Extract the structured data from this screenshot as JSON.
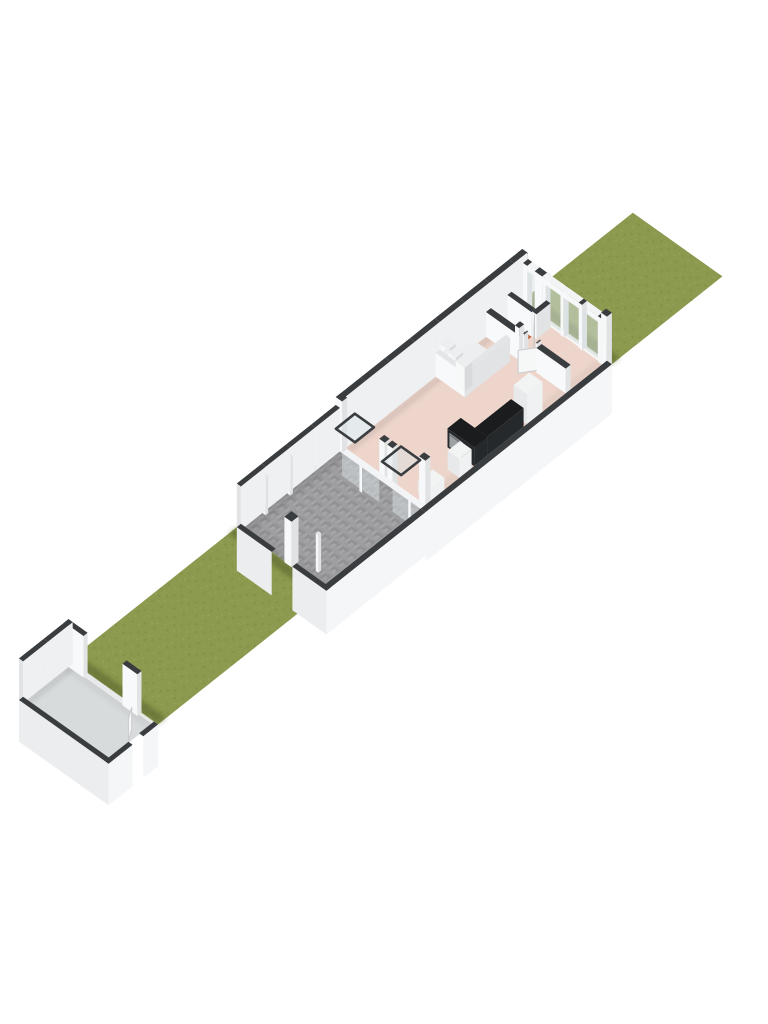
{
  "scene": {
    "label": "3D floorplan render of ground floor with gardens",
    "projection": {
      "ox": 19,
      "oy": 700,
      "ux": 16.5,
      "uy": -13.1,
      "vx": 16.6,
      "vy": 11.8,
      "hz": 19.8
    },
    "colors": {
      "bg": "#ffffff",
      "grass": "#8B9A4F",
      "grassDot1": "#7F8F45",
      "grassDot2": "#95A45A",
      "grassShadow": "rgba(62,72,30,0.40)",
      "paving": "#9B9B9E",
      "pavingA": "#A6A6A8",
      "pavingB": "#929295",
      "pavingC": "#9F9FA2",
      "garageFloor": "#D8DBDC",
      "floorPink": "#EDD5CB",
      "floorTerracotta": "#BF5B3A",
      "floorCloset": "#E9EAEC",
      "capDark": "#3A3D3F",
      "capLight": "#E4E5E7",
      "wallLight": "#EFF0F2",
      "wallBright": "#F8F9FA",
      "wallShade": "#DMISSING",
      "wallSW": "#EBEDEE",
      "wallSE": "#F5F6F7",
      "wallEnd": "#E2E3E5",
      "glass": "#D9E2E4",
      "glassStroke": "#3A3D40",
      "rail": "#F3F4F5",
      "post": "#F7F8F9",
      "postSide": "#E0E2E4",
      "threshold": "#E8E9EA",
      "counterTop": "#1A1C1D",
      "counterFace": "#26292B",
      "ovenGray": "#9EA2A4",
      "ovenHandle": "#6E7173",
      "sinkDark": "#0D0E0F",
      "sinkRim": "#AEB2B4",
      "fridgeTop": "#F2F3F3",
      "fridgeSW": "#E7E9EA",
      "fridgeSE": "#F0F1F2",
      "treadTop": "#EDEEEF",
      "treadRiser": "#F7F8F8",
      "treadSide": "#D9DADC",
      "doorLeaf": "#F6F7F7",
      "doorEdge": "#C8CACC",
      "jambDark": "#55585A",
      "floorShadow": "rgba(0,0,0,0.09)",
      "floorShadowSoft": "rgba(0,0,0,0.05)"
    },
    "plot": {
      "width_m": 5.4,
      "segments": [
        {
          "name": "garage",
          "u0": 0.0,
          "u1": 3.0
        },
        {
          "name": "front-garden",
          "u0": 3.0,
          "u1": 13.2
        },
        {
          "name": "patio",
          "u0": 13.2,
          "u1": 19.2
        },
        {
          "name": "house",
          "u0": 19.2,
          "u1": 30.5
        },
        {
          "name": "back-garden",
          "u0": 30.5,
          "u1": 37.2
        }
      ]
    },
    "floors": [
      {
        "name": "front-garden-grass",
        "u0": 3.0,
        "v0": 0,
        "u1": 13.2,
        "v1": 5.4,
        "fill": "pat:grass"
      },
      {
        "name": "back-garden-grass",
        "u0": 30.5,
        "v0": 0,
        "u1": 37.2,
        "v1": 5.4,
        "fill": "pat:grass"
      },
      {
        "name": "garage-floor",
        "u0": 0.2,
        "v0": 0.2,
        "u1": 2.85,
        "v1": 5.2,
        "fill": "garageFloor"
      },
      {
        "name": "patio-paving",
        "u0": 13.2,
        "v0": 0,
        "u1": 19.2,
        "v1": 5.4,
        "fill": "pat:paving"
      },
      {
        "name": "house-floor",
        "u0": 19.4,
        "v0": 0.28,
        "u1": 30.25,
        "v1": 5.12,
        "fill": "floorPink"
      },
      {
        "name": "wc-floor",
        "u0": 28.3,
        "v0": 0.3,
        "u1": 29.3,
        "v1": 1.75,
        "fill": "floorTerracotta"
      },
      {
        "name": "closet-floor",
        "u0": 29.55,
        "v0": 0.3,
        "u1": 30.2,
        "v1": 1.75,
        "fill": "floorCloset"
      }
    ],
    "shadows": [
      {
        "name": "garage-shadow-on-grass",
        "u0": 3.0,
        "v0": 0,
        "u1": 3.5,
        "v1": 5.4,
        "fill": "grassShadow"
      },
      {
        "name": "patio-wall-shadow-on-grass",
        "u0": 12.7,
        "v0": 0,
        "u1": 13.2,
        "v1": 5.4,
        "fill": "grassShadow"
      },
      {
        "name": "house-shadow-on-back-grass",
        "u0": 30.5,
        "v0": 0,
        "u1": 31.0,
        "v1": 5.4,
        "fill": "grassShadow"
      },
      {
        "name": "patio-nw-wall-shadow",
        "u0": 13.45,
        "v0": 0.25,
        "u1": 19.2,
        "v1": 0.62,
        "fill": "floorShadow"
      },
      {
        "name": "patio-sw-wall-shadow",
        "u0": 13.45,
        "v0": 0.25,
        "u1": 13.75,
        "v1": 5.1,
        "fill": "floorShadowSoft"
      },
      {
        "name": "house-nw-wall-shadow",
        "u0": 19.5,
        "v0": 0.3,
        "u1": 30.2,
        "v1": 0.64,
        "fill": "floorShadow"
      },
      {
        "name": "house-se-wall-shadow",
        "u0": 19.5,
        "v0": 4.78,
        "u1": 30.2,
        "v1": 5.1,
        "fill": "floorShadowSoft"
      },
      {
        "name": "garage-nw-wall-shadow",
        "u0": 0.25,
        "v0": 0.2,
        "u1": 2.85,
        "v1": 0.55,
        "fill": "floorShadow"
      },
      {
        "name": "garage-ne-wall-shadow",
        "u0": 2.5,
        "v0": 0.2,
        "u1": 2.85,
        "v1": 5.2,
        "fill": "floorShadowSoft"
      }
    ],
    "walls": [
      {
        "name": "garage-nw-wall",
        "t": "farU",
        "u0": 0,
        "v0": 0,
        "u1": 3.0,
        "v1": 0.25,
        "h": 2.1,
        "cap": "capDark",
        "in": "wallLight"
      },
      {
        "name": "garage-ne-wall-a",
        "t": "farV",
        "u0": 2.75,
        "v0": 0,
        "u1": 3.0,
        "v1": 1.15,
        "h": 2.1,
        "cap": "capDark",
        "in": "wallBright"
      },
      {
        "name": "garage-ne-wall-b",
        "t": "farV",
        "u0": 2.75,
        "v0": 3.5,
        "u1": 3.0,
        "v1": 4.4,
        "h": 2.1,
        "cap": "capDark",
        "in": "wallBright"
      },
      {
        "name": "garage-sw-wall",
        "t": "nearV",
        "uIn": 0.25,
        "v0": 0,
        "v1": 5.4,
        "h": 2.1,
        "th": 0.25,
        "cap": "capDark",
        "out": "wallSW"
      },
      {
        "name": "garage-se-wall-a",
        "t": "nearU",
        "vIn": 5.15,
        "u0": 0,
        "u1": 1.45,
        "h": 2.1,
        "th": 0.25,
        "cap": "capDark",
        "out": "wallSE"
      },
      {
        "name": "garage-se-wall-b",
        "t": "nearU",
        "vIn": 5.15,
        "u0": 2.1,
        "u1": 3.0,
        "h": 2.1,
        "th": 0.25,
        "cap": "capDark",
        "out": "wallSE"
      },
      {
        "name": "patio-nw-wall",
        "t": "farU",
        "u0": 13.2,
        "v0": 0,
        "u1": 19.2,
        "v1": 0.25,
        "h": 2.2,
        "cap": "capDark",
        "in": "wallLight"
      },
      {
        "name": "patio-sw-wall-a",
        "t": "nearV",
        "uIn": 13.45,
        "v0": 0,
        "v1": 2.1,
        "h": 2.2,
        "th": 0.25,
        "cap": "capDark",
        "out": "wallSW"
      },
      {
        "name": "patio-sw-wall-b",
        "t": "nearV",
        "uIn": 13.45,
        "v0": 3.35,
        "v1": 5.4,
        "h": 2.2,
        "th": 0.25,
        "cap": "capDark",
        "out": "wallSW"
      },
      {
        "name": "patio-se-wall",
        "t": "nearU",
        "vIn": 5.1,
        "u0": 13.2,
        "u1": 19.2,
        "h": 2.2,
        "th": 0.3,
        "cap": "capDark",
        "out": "wallSE"
      },
      {
        "name": "house-nw-wall",
        "t": "farU",
        "u0": 19.2,
        "v0": 0,
        "u1": 30.5,
        "v1": 0.3,
        "h": 2.6,
        "cap": "capDark",
        "in": "wallLight"
      },
      {
        "name": "house-se-wall",
        "t": "nearU",
        "vIn": 5.1,
        "u0": 19.2,
        "u1": 30.5,
        "h": 2.5,
        "th": 0.3,
        "cap": "capDark",
        "out": "wallSE"
      },
      {
        "name": "ne-facade-solid-a",
        "t": "farV",
        "u0": 30.2,
        "v0": 0.35,
        "u1": 30.5,
        "v1": 0.6,
        "h": 2.3,
        "cap": "capDark",
        "in": "wallBright"
      },
      {
        "name": "ne-facade-solid-b",
        "t": "farV",
        "u0": 30.2,
        "v0": 1.05,
        "u1": 30.5,
        "v1": 1.5,
        "h": 2.3,
        "cap": "capDark",
        "in": "wallBright"
      },
      {
        "name": "stairs-wall-sw",
        "t": "box",
        "u0": 24.95,
        "v0": 0.3,
        "u1": 25.2,
        "v1": 2.05,
        "h": 1.2,
        "cap": "capLight",
        "sw": "wallBright",
        "se": "wallEnd"
      },
      {
        "name": "stairs-wall-se",
        "t": "box",
        "u0": 24.95,
        "v0": 1.8,
        "u1": 27.7,
        "v1": 2.05,
        "h": 1.2,
        "cap": "capLight",
        "sw": "wallBright",
        "se": "wallEnd"
      },
      {
        "name": "hall-wall-a",
        "t": "box",
        "u0": 28.0,
        "v0": 0.3,
        "u1": 28.3,
        "v1": 2.5,
        "h": 1.25,
        "cap": "capDark",
        "sw": "wallBright",
        "se": "wallEnd"
      },
      {
        "name": "hall-wall-b",
        "t": "box",
        "u0": 28.0,
        "v0": 3.35,
        "u1": 28.3,
        "v1": 5.1,
        "h": 1.25,
        "cap": "capDark",
        "sw": "wallBright",
        "se": "wallEnd"
      },
      {
        "name": "wc-wall-a",
        "t": "box",
        "u0": 28.3,
        "v0": 1.75,
        "u1": 28.6,
        "v1": 2.0,
        "h": 1.25,
        "cap": "capDark",
        "sw": "wallBright",
        "se": "wallEnd"
      },
      {
        "name": "wc-wall-b",
        "t": "box",
        "u0": 29.35,
        "v0": 1.75,
        "u1": 30.2,
        "v1": 2.0,
        "h": 1.25,
        "cap": "capDark",
        "sw": "wallBright",
        "se": "wallEnd"
      },
      {
        "name": "wc-closet-wall",
        "t": "box",
        "u0": 29.3,
        "v0": 0.3,
        "u1": 29.55,
        "v1": 1.75,
        "h": 1.25,
        "cap": "capDark",
        "sw": "wallBright",
        "se": "wallEnd"
      }
    ],
    "piers": [
      {
        "name": "sw-facade-corner-pier-nw",
        "u0": 19.2,
        "v0": 0,
        "u1": 19.5,
        "v1": 0.38,
        "h": 2.6,
        "cap": "capDark"
      },
      {
        "name": "sw-facade-corner-pier-se",
        "u0": 19.2,
        "v0": 5.02,
        "u1": 19.5,
        "v1": 5.4,
        "h": 2.6,
        "cap": "capDark"
      },
      {
        "name": "sw-facade-mid-pier-a",
        "u0": 19.2,
        "v0": 2.62,
        "u1": 19.5,
        "v1": 2.95,
        "h": 2.05,
        "cap": "capDark"
      },
      {
        "name": "sw-facade-mid-pier-b",
        "u0": 19.2,
        "v0": 3.1,
        "u1": 19.5,
        "v1": 3.42,
        "h": 2.05,
        "cap": "capDark"
      },
      {
        "name": "ne-facade-corner-pier-nw",
        "u0": 30.2,
        "v0": 0,
        "u1": 30.5,
        "v1": 0.35,
        "h": 2.6,
        "cap": "capDark"
      },
      {
        "name": "ne-facade-corner-pier-se",
        "u0": 30.2,
        "v0": 5.05,
        "u1": 30.5,
        "v1": 5.4,
        "h": 2.6,
        "cap": "capDark"
      },
      {
        "name": "patio-gate-post",
        "u0": 13.15,
        "v0": 2.92,
        "u1": 13.57,
        "v1": 3.35,
        "h": 2.3,
        "cap": "capDark"
      },
      {
        "name": "patio-fence-post-1",
        "u0": 14.5,
        "v0": 0.28,
        "u1": 14.66,
        "v1": 0.44,
        "h": 1.9,
        "cap": "capLight"
      },
      {
        "name": "patio-fence-post-2",
        "u0": 16.0,
        "v0": 0.28,
        "u1": 16.16,
        "v1": 0.44,
        "h": 1.9,
        "cap": "capLight"
      },
      {
        "name": "patio-fence-post-3",
        "u0": 13.7,
        "v0": 4.26,
        "u1": 13.86,
        "v1": 4.42,
        "h": 1.9,
        "cap": "capLight"
      },
      {
        "name": "ne-facade-post-1",
        "u0": 30.2,
        "v0": 1.5,
        "u1": 30.5,
        "v1": 1.7,
        "h": 2.3,
        "cap": "capDark"
      },
      {
        "name": "ne-facade-post-2",
        "u0": 30.2,
        "v0": 2.6,
        "u1": 30.5,
        "v1": 2.8,
        "h": 2.3,
        "cap": "capDark"
      },
      {
        "name": "ne-facade-post-3",
        "u0": 30.2,
        "v0": 3.7,
        "u1": 30.5,
        "v1": 3.9,
        "h": 2.3,
        "cap": "capDark"
      },
      {
        "name": "ne-facade-post-4",
        "u0": 30.2,
        "v0": 4.85,
        "u1": 30.5,
        "v1": 5.05,
        "h": 2.3,
        "cap": "capDark"
      },
      {
        "name": "door-jamb-a",
        "u0": 28.03,
        "v0": 2.5,
        "u1": 28.27,
        "v1": 2.58,
        "h": 1.45,
        "cap": "jambDark"
      },
      {
        "name": "door-jamb-b",
        "u0": 28.03,
        "v0": 3.27,
        "u1": 28.27,
        "v1": 3.35,
        "h": 1.45,
        "cap": "jambDark"
      }
    ],
    "glazing": [
      {
        "name": "rear-window-slit",
        "t": "vglass",
        "u": 30.25,
        "v0": 0.6,
        "v1": 1.05,
        "h0": 0.08,
        "h1": 2.0
      },
      {
        "name": "rear-window-1",
        "t": "vglass",
        "u": 30.25,
        "v0": 1.7,
        "v1": 2.6,
        "h0": 0.08,
        "h1": 2.0
      },
      {
        "name": "rear-window-2",
        "t": "vglass",
        "u": 30.25,
        "v0": 2.8,
        "v1": 3.7,
        "h0": 0.08,
        "h1": 2.0
      },
      {
        "name": "rear-window-3",
        "t": "vglass",
        "u": 30.25,
        "v0": 3.9,
        "v1": 4.85,
        "h0": 0.08,
        "h1": 2.0
      },
      {
        "name": "rear-window-rail",
        "t": "railbox",
        "u0": 30.2,
        "v0": 1.5,
        "u1": 30.5,
        "v1": 5.05,
        "h0": 2.0,
        "h1": 2.3
      },
      {
        "name": "rear-slit-rail",
        "t": "railbox",
        "u0": 30.2,
        "v0": 0.6,
        "u1": 30.5,
        "v1": 1.05,
        "h0": 2.0,
        "h1": 2.3
      },
      {
        "name": "front-facade-rail",
        "t": "hangcap",
        "uIn": 19.5,
        "v0": 0.38,
        "v1": 5.02,
        "th": 0.3,
        "fill": "rail"
      },
      {
        "name": "front-glass-1",
        "t": "hangglass",
        "uIn": 19.5,
        "v0": 0.38,
        "v1": 1.42,
        "th": 0.3,
        "dh": 1.15
      },
      {
        "name": "front-glass-2",
        "t": "hangglass",
        "uIn": 19.5,
        "v0": 1.58,
        "v1": 2.62,
        "th": 0.3,
        "dh": 1.15
      },
      {
        "name": "front-glass-3",
        "t": "hangglass",
        "uIn": 19.5,
        "v0": 3.42,
        "v1": 4.36,
        "th": 0.3,
        "dh": 1.15
      },
      {
        "name": "front-glass-4",
        "t": "hangglass",
        "uIn": 19.5,
        "v0": 4.52,
        "v1": 5.02,
        "th": 0.3,
        "dh": 1.15
      },
      {
        "name": "front-post-1",
        "t": "hangpost",
        "uIn": 19.5,
        "v0": 1.42,
        "v1": 1.58,
        "th": 0.3,
        "dh": 1.3
      },
      {
        "name": "front-post-2",
        "t": "hangpost",
        "uIn": 19.5,
        "v0": 4.36,
        "v1": 4.52,
        "th": 0.3,
        "dh": 1.3
      }
    ],
    "open_panels": [
      {
        "name": "open-window-panel-1",
        "u0": 18.6,
        "v0": 0.6,
        "u1": 19.75,
        "v1": 1.75,
        "h": 1.75
      },
      {
        "name": "open-window-panel-2",
        "u0": 18.6,
        "v0": 3.38,
        "u1": 19.75,
        "v1": 4.53,
        "h": 1.75
      }
    ],
    "stairs": {
      "straight": {
        "count": 7,
        "uStart": 27.4,
        "step": 0.3,
        "v0": 0.35,
        "v1": 1.78,
        "h0": 0.14,
        "rise": 0.15
      },
      "winders": [
        {
          "u0": 25.2,
          "v0": 1.25,
          "u1": 25.66,
          "v1": 1.8,
          "h": 1.19
        },
        {
          "u0": 25.2,
          "v0": 0.8,
          "u1": 25.66,
          "v1": 1.25,
          "h": 1.34
        },
        {
          "u0": 25.2,
          "v0": 0.35,
          "u1": 25.66,
          "v1": 0.8,
          "h": 1.49
        }
      ]
    },
    "furniture": [
      {
        "name": "kitchen-counter-leg",
        "t": "box3",
        "u0": 22.45,
        "v0": 3.5,
        "u1": 23.25,
        "v1": 5.1,
        "h": 0.95,
        "top": "counterTop",
        "sw": "counterFace",
        "se": "counterFace"
      },
      {
        "name": "kitchen-counter-run",
        "t": "box3",
        "u0": 23.25,
        "v0": 4.35,
        "u1": 25.45,
        "v1": 5.1,
        "h": 0.95,
        "top": "counterTop",
        "sw": "counterFace",
        "se": "counterFace"
      },
      {
        "name": "oven-front",
        "t": "vpanel",
        "u": 22.44,
        "v0": 3.62,
        "v1": 4.42,
        "h0": 0.1,
        "h1": 0.8,
        "fill": "ovenGray"
      },
      {
        "name": "oven-handle",
        "t": "vpanel",
        "u": 22.43,
        "v0": 3.66,
        "v1": 4.38,
        "h0": 0.68,
        "h1": 0.76,
        "fill": "ovenHandle"
      },
      {
        "name": "kitchen-sink",
        "t": "hpanel",
        "u0": 22.58,
        "v0": 3.64,
        "u1": 23.12,
        "v1": 4.3,
        "h": 0.96,
        "fill": "sinkDark",
        "stroke": "sinkRim"
      },
      {
        "name": "fridge",
        "t": "box3",
        "u0": 25.65,
        "v0": 4.3,
        "u1": 26.6,
        "v1": 5.1,
        "h": 1.5,
        "top": "fridgeTop",
        "sw": "fridgeSW",
        "se": "fridgeSE"
      },
      {
        "name": "low-cabinet",
        "t": "box3",
        "u0": 19.75,
        "v0": 4.4,
        "u1": 20.65,
        "v1": 5.1,
        "h": 0.6,
        "top": "fridgeTop",
        "sw": "fridgeSW",
        "se": "fridgeSE"
      },
      {
        "name": "tall-cabinet",
        "t": "box3",
        "u0": 21.55,
        "v0": 4.4,
        "u1": 22.3,
        "v1": 5.1,
        "h": 0.95,
        "top": "fridgeTop",
        "sw": "fridgeSW",
        "se": "fridgeSE"
      },
      {
        "name": "garage-threshold",
        "t": "box3",
        "u0": 2.8,
        "v0": 1.15,
        "u1": 3.0,
        "v1": 3.5,
        "h": 0.07,
        "top": "threshold",
        "sw": "wallSW",
        "se": "wallEnd"
      }
    ],
    "doors": [
      {
        "name": "living-room-door",
        "au": 28.15,
        "av": 3.3,
        "bu": 27.45,
        "bv": 2.78,
        "h": 1.15
      },
      {
        "name": "wc-door",
        "au": 29.35,
        "av": 1.88,
        "bu": 28.78,
        "bv": 2.42,
        "h": 1.15
      },
      {
        "name": "garage-side-door",
        "au": 1.5,
        "av": 5.1,
        "bu": 2.05,
        "bv": 4.75,
        "h": 1.1
      }
    ]
  }
}
